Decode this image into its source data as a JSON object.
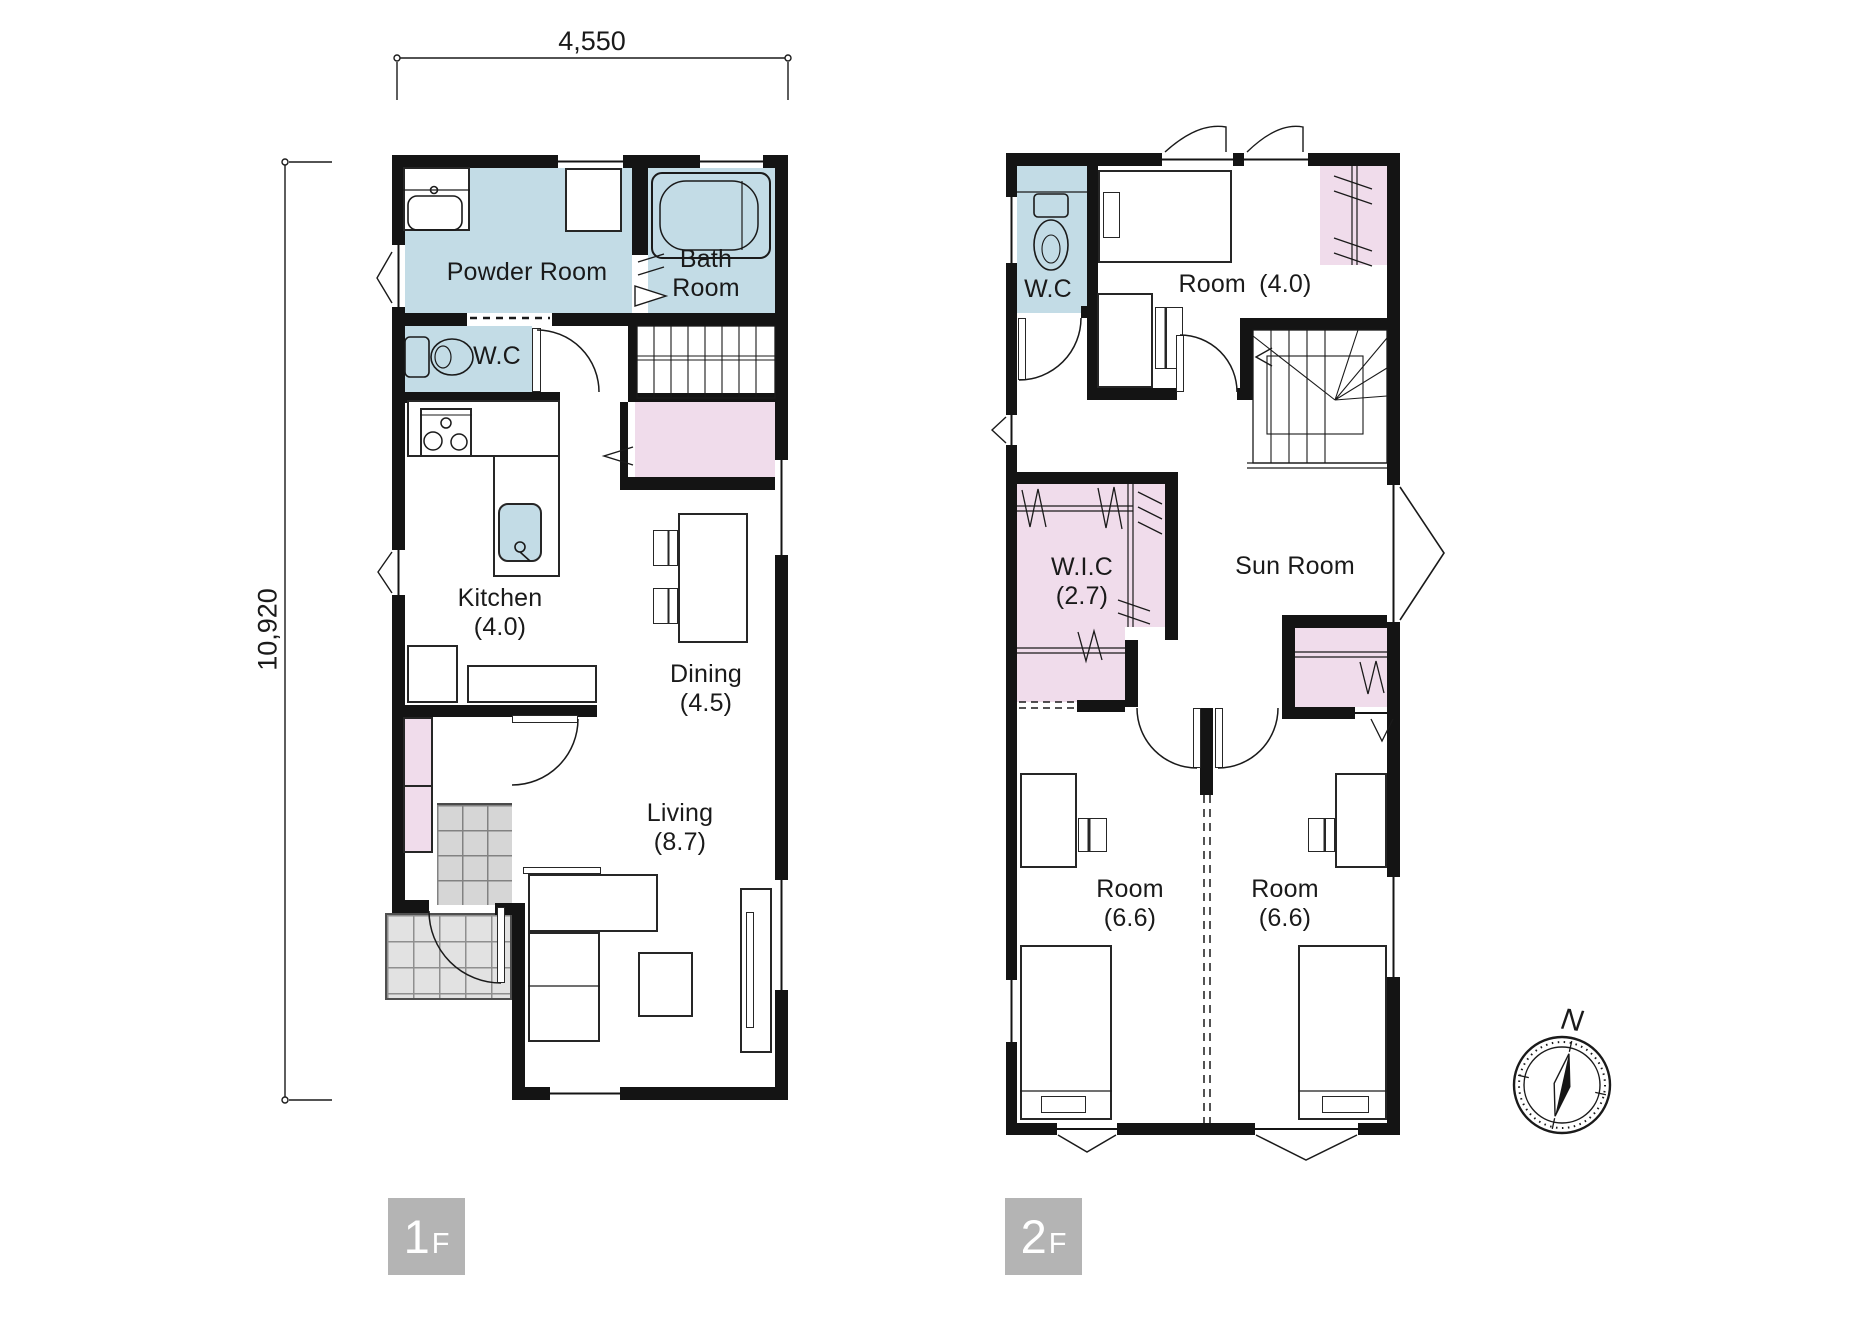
{
  "dimensions": {
    "top": "4,550",
    "side": "10,920"
  },
  "floors": {
    "f1": {
      "badge_number": "1",
      "badge_suffix": "F",
      "powder_room": "Powder Room",
      "bath_line1": "Bath",
      "bath_line2": "Room",
      "wc": "W.C",
      "kitchen": "Kitchen",
      "kitchen_size": "(4.0)",
      "dining": "Dining",
      "dining_size": "(4.5)",
      "living": "Living",
      "living_size": "(8.7)"
    },
    "f2": {
      "badge_number": "2",
      "badge_suffix": "F",
      "wc": "W.C",
      "room4": "Room (4.0)",
      "wic": "W.I.C",
      "wic_size": "(2.7)",
      "sun_room": "Sun Room",
      "room_left": "Room",
      "room_left_size": "(6.6)",
      "room_right": "Room",
      "room_right_size": "(6.6)"
    }
  },
  "compass": {
    "north": "N"
  },
  "colors": {
    "wet_area": "#c3dce6",
    "closet": "#f0dceb",
    "wall": "#141414",
    "tile_inner": "#d6d6d6",
    "tile_porch": "#e2e2e2",
    "badge_bg": "#b4b4b4",
    "badge_text": "#ffffff"
  }
}
